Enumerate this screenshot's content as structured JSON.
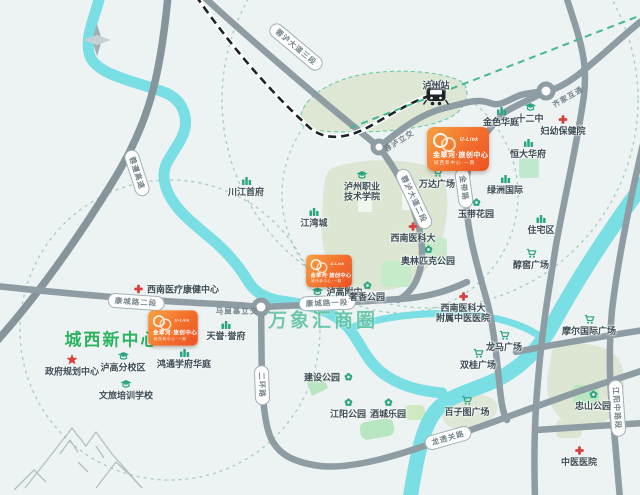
{
  "map": {
    "compass_label": "N",
    "project_banner": {
      "brand": "U-Link",
      "title": "金翠河·旅创中心",
      "subtitle": "城西新中心·一期",
      "color_start": "#f9a141",
      "color_end": "#ed5226",
      "placements": [
        {
          "x": 458,
          "y": 149,
          "s": 1
        },
        {
          "x": 329,
          "y": 271,
          "s": 0.74
        },
        {
          "x": 173,
          "y": 328,
          "s": 0.8
        }
      ]
    },
    "area_titles": [
      {
        "id": "chengxi-new-center",
        "text": "城西新中心",
        "x": 112,
        "y": 338,
        "size": 17,
        "ls": 2,
        "color": "#2db35f"
      },
      {
        "id": "wanxianghui-business-circle",
        "text": "万象汇商圈",
        "x": 323,
        "y": 319,
        "size": 19,
        "ls": 3,
        "color": "rgba(75,186,150,0.8)"
      }
    ],
    "road_labels": [
      {
        "text": "蓉遵高速",
        "x": 137,
        "y": 173,
        "rot": 72,
        "style": "capsule"
      },
      {
        "text": "蓉泸大道三段",
        "x": 296,
        "y": 47,
        "rot": 40,
        "style": "capsule"
      },
      {
        "text": "蓉泸大道二段",
        "x": 414,
        "y": 199,
        "rot": 65,
        "style": "capsule"
      },
      {
        "text": "康城路二段",
        "x": 136,
        "y": 302,
        "rot": 4,
        "style": "capsule"
      },
      {
        "text": "康城路一段",
        "x": 327,
        "y": 303,
        "rot": -2,
        "style": "capsule"
      },
      {
        "text": "金带路",
        "x": 464,
        "y": 188,
        "rot": 82,
        "style": "capsule"
      },
      {
        "text": "二环路",
        "x": 262,
        "y": 385,
        "rot": 88,
        "style": "capsule"
      },
      {
        "text": "龙透关路",
        "x": 448,
        "y": 438,
        "rot": -16,
        "style": "capsule"
      },
      {
        "text": "江阳中路段",
        "x": 617,
        "y": 408,
        "rot": 86,
        "style": "capsule"
      },
      {
        "text": "齐家互通",
        "x": 568,
        "y": 97,
        "rot": -30,
        "style": "plain"
      },
      {
        "text": "蓉泸立交",
        "x": 399,
        "y": 141,
        "rot": -32,
        "style": "plain"
      },
      {
        "text": "马屋基立交",
        "x": 237,
        "y": 311,
        "rot": 0,
        "style": "plain"
      }
    ],
    "pois": [
      {
        "id": "luzhou-station",
        "text": "泸州站",
        "x": 436,
        "y": 86,
        "icon": "train",
        "icon_pos": "below"
      },
      {
        "id": "jinse-huating",
        "text": "金色华庭",
        "x": 501,
        "y": 116,
        "icon": "building"
      },
      {
        "id": "no12-middle-school",
        "text": "十二中",
        "x": 530,
        "y": 113,
        "icon": "school"
      },
      {
        "id": "fuyou-baojianyuan",
        "text": "妇幼保健院",
        "x": 563,
        "y": 125,
        "icon": "hospital"
      },
      {
        "id": "hengda-huafu",
        "text": "恒大华府",
        "x": 528,
        "y": 148,
        "icon": "building"
      },
      {
        "id": "lvzhou-guoji",
        "text": "绿洲国际",
        "x": 505,
        "y": 184,
        "icon": "building"
      },
      {
        "id": "yudai-huayuan",
        "text": "玉带花园",
        "x": 476,
        "y": 208,
        "icon": "park"
      },
      {
        "id": "zhuzhaiqu",
        "text": "住宅区",
        "x": 541,
        "y": 224,
        "icon": "building"
      },
      {
        "id": "wanda-plaza",
        "text": "万达广场",
        "x": 437,
        "y": 178,
        "icon": "cart"
      },
      {
        "id": "luzhou-vocational",
        "lines": [
          "泸州职业",
          "技术学院"
        ],
        "x": 362,
        "y": 186,
        "icon": "school"
      },
      {
        "id": "jiangwan-cheng",
        "text": "江湾城",
        "x": 314,
        "y": 217,
        "icon": "building"
      },
      {
        "id": "chuanjiang-shoufu",
        "text": "川江首府",
        "x": 246,
        "y": 186,
        "icon": "building"
      },
      {
        "id": "swmu",
        "text": "西南医科大",
        "x": 413,
        "y": 232,
        "icon": "hospital"
      },
      {
        "id": "olympic-park",
        "text": "奥林匹克公园",
        "x": 428,
        "y": 255,
        "icon": "park"
      },
      {
        "id": "lugao-fuzhong",
        "text": "泸高附中",
        "x": 337,
        "y": 292,
        "icon": "school",
        "icon_pos": "left"
      },
      {
        "id": "shexiang-park",
        "text": "奢香公园",
        "x": 367,
        "y": 291,
        "icon": "park"
      },
      {
        "id": "swm-kangjian",
        "text": "西南医疗康健中心",
        "x": 176,
        "y": 289,
        "icon": "hospital",
        "icon_pos": "left"
      },
      {
        "id": "tianyu-yufu",
        "text": "天誉·誉府",
        "x": 226,
        "y": 330,
        "icon": "building"
      },
      {
        "id": "hongtong-xuefu",
        "text": "鸿通学府华庭",
        "x": 184,
        "y": 358,
        "icon": "building"
      },
      {
        "id": "gov-planning-center",
        "text": "政府规划中心",
        "x": 72,
        "y": 365,
        "icon": "star"
      },
      {
        "id": "lugao-fenxiao",
        "text": "泸高分校区",
        "x": 123,
        "y": 362,
        "icon": "school"
      },
      {
        "id": "wenlv-school",
        "text": "文旅培训学校",
        "x": 126,
        "y": 390,
        "icon": "school"
      },
      {
        "id": "jianshe-park",
        "text": "建设公园",
        "x": 329,
        "y": 377,
        "icon": "park",
        "icon_pos": "right"
      },
      {
        "id": "jiangyang-park",
        "text": "江阳公园",
        "x": 348,
        "y": 408,
        "icon": "park"
      },
      {
        "id": "jiucheng-leyuan",
        "text": "酒城乐园",
        "x": 388,
        "y": 408,
        "icon": "park"
      },
      {
        "id": "baizitu-plaza",
        "text": "百子图广场",
        "x": 467,
        "y": 406,
        "icon": "cart"
      },
      {
        "id": "shuanggui-plaza",
        "text": "双桂广场",
        "x": 478,
        "y": 359,
        "icon": "cart"
      },
      {
        "id": "longma-plaza",
        "text": "龙马广场",
        "x": 504,
        "y": 341,
        "icon": "cart"
      },
      {
        "id": "moer-intl-plaza",
        "text": "摩尔国际广场",
        "x": 589,
        "y": 325,
        "icon": "cart"
      },
      {
        "id": "chunjiao-plaza",
        "text": "醇窖广场",
        "x": 531,
        "y": 259,
        "icon": "cart"
      },
      {
        "id": "swmu-tcm-hospital",
        "lines": [
          "西南医科大",
          "附属中医医院"
        ],
        "x": 463,
        "y": 307,
        "icon": "hospital"
      },
      {
        "id": "zhongshan-park",
        "text": "忠山公园",
        "x": 593,
        "y": 400,
        "icon": "park"
      },
      {
        "id": "tcm-hospital",
        "text": "中医医院",
        "x": 579,
        "y": 456,
        "icon": "hospital"
      }
    ]
  }
}
